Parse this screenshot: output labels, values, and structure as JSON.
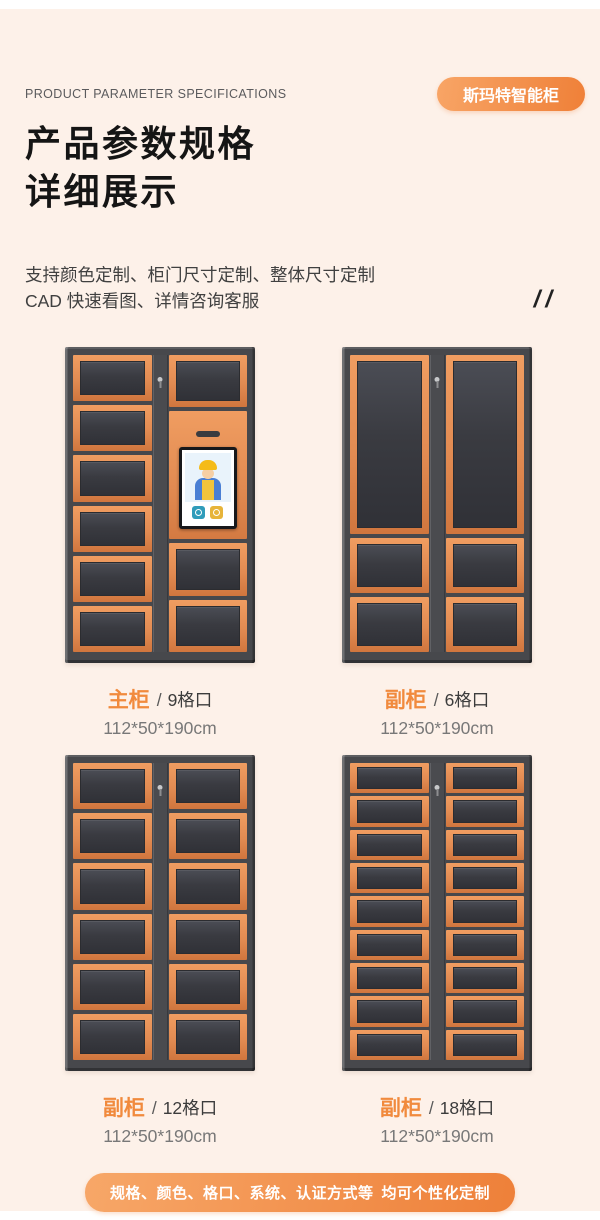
{
  "header": {
    "eyebrow": "PRODUCT PARAMETER SPECIFICATIONS",
    "brand_badge": "斯玛特智能柜",
    "title_line1": "产品参数规格",
    "title_line2": "详细展示",
    "subtitle_line1": "支持颜色定制、柜门尺寸定制、整体尺寸定制",
    "subtitle_line2": "CAD 快速看图、详情咨询客服",
    "decor_slashes": "//"
  },
  "cabinets": [
    {
      "name": "主柜",
      "sep": "/",
      "count": "9格口",
      "dims": "112*50*190cm",
      "structure": "main-with-screen"
    },
    {
      "name": "副柜",
      "sep": "/",
      "count": "6格口",
      "dims": "112*50*190cm",
      "structure": "two-columns-tall-plus-2"
    },
    {
      "name": "副柜",
      "sep": "/",
      "count": "12格口",
      "dims": "112*50*190cm",
      "structure": "two-columns-6-rows"
    },
    {
      "name": "副柜",
      "sep": "/",
      "count": "18格口",
      "dims": "112*50*190cm",
      "structure": "two-columns-9-rows"
    }
  ],
  "footer": {
    "pill_text": "规格、颜色、格口、系统、认证方式等 均可个性化定制"
  },
  "colors": {
    "background": "#fdf1e9",
    "accent_orange": "#f18a3d",
    "badge_gradient_start": "#f8a566",
    "badge_gradient_end": "#ef8038",
    "door_orange": "#e28b52",
    "cabinet_frame": "#47484c"
  }
}
